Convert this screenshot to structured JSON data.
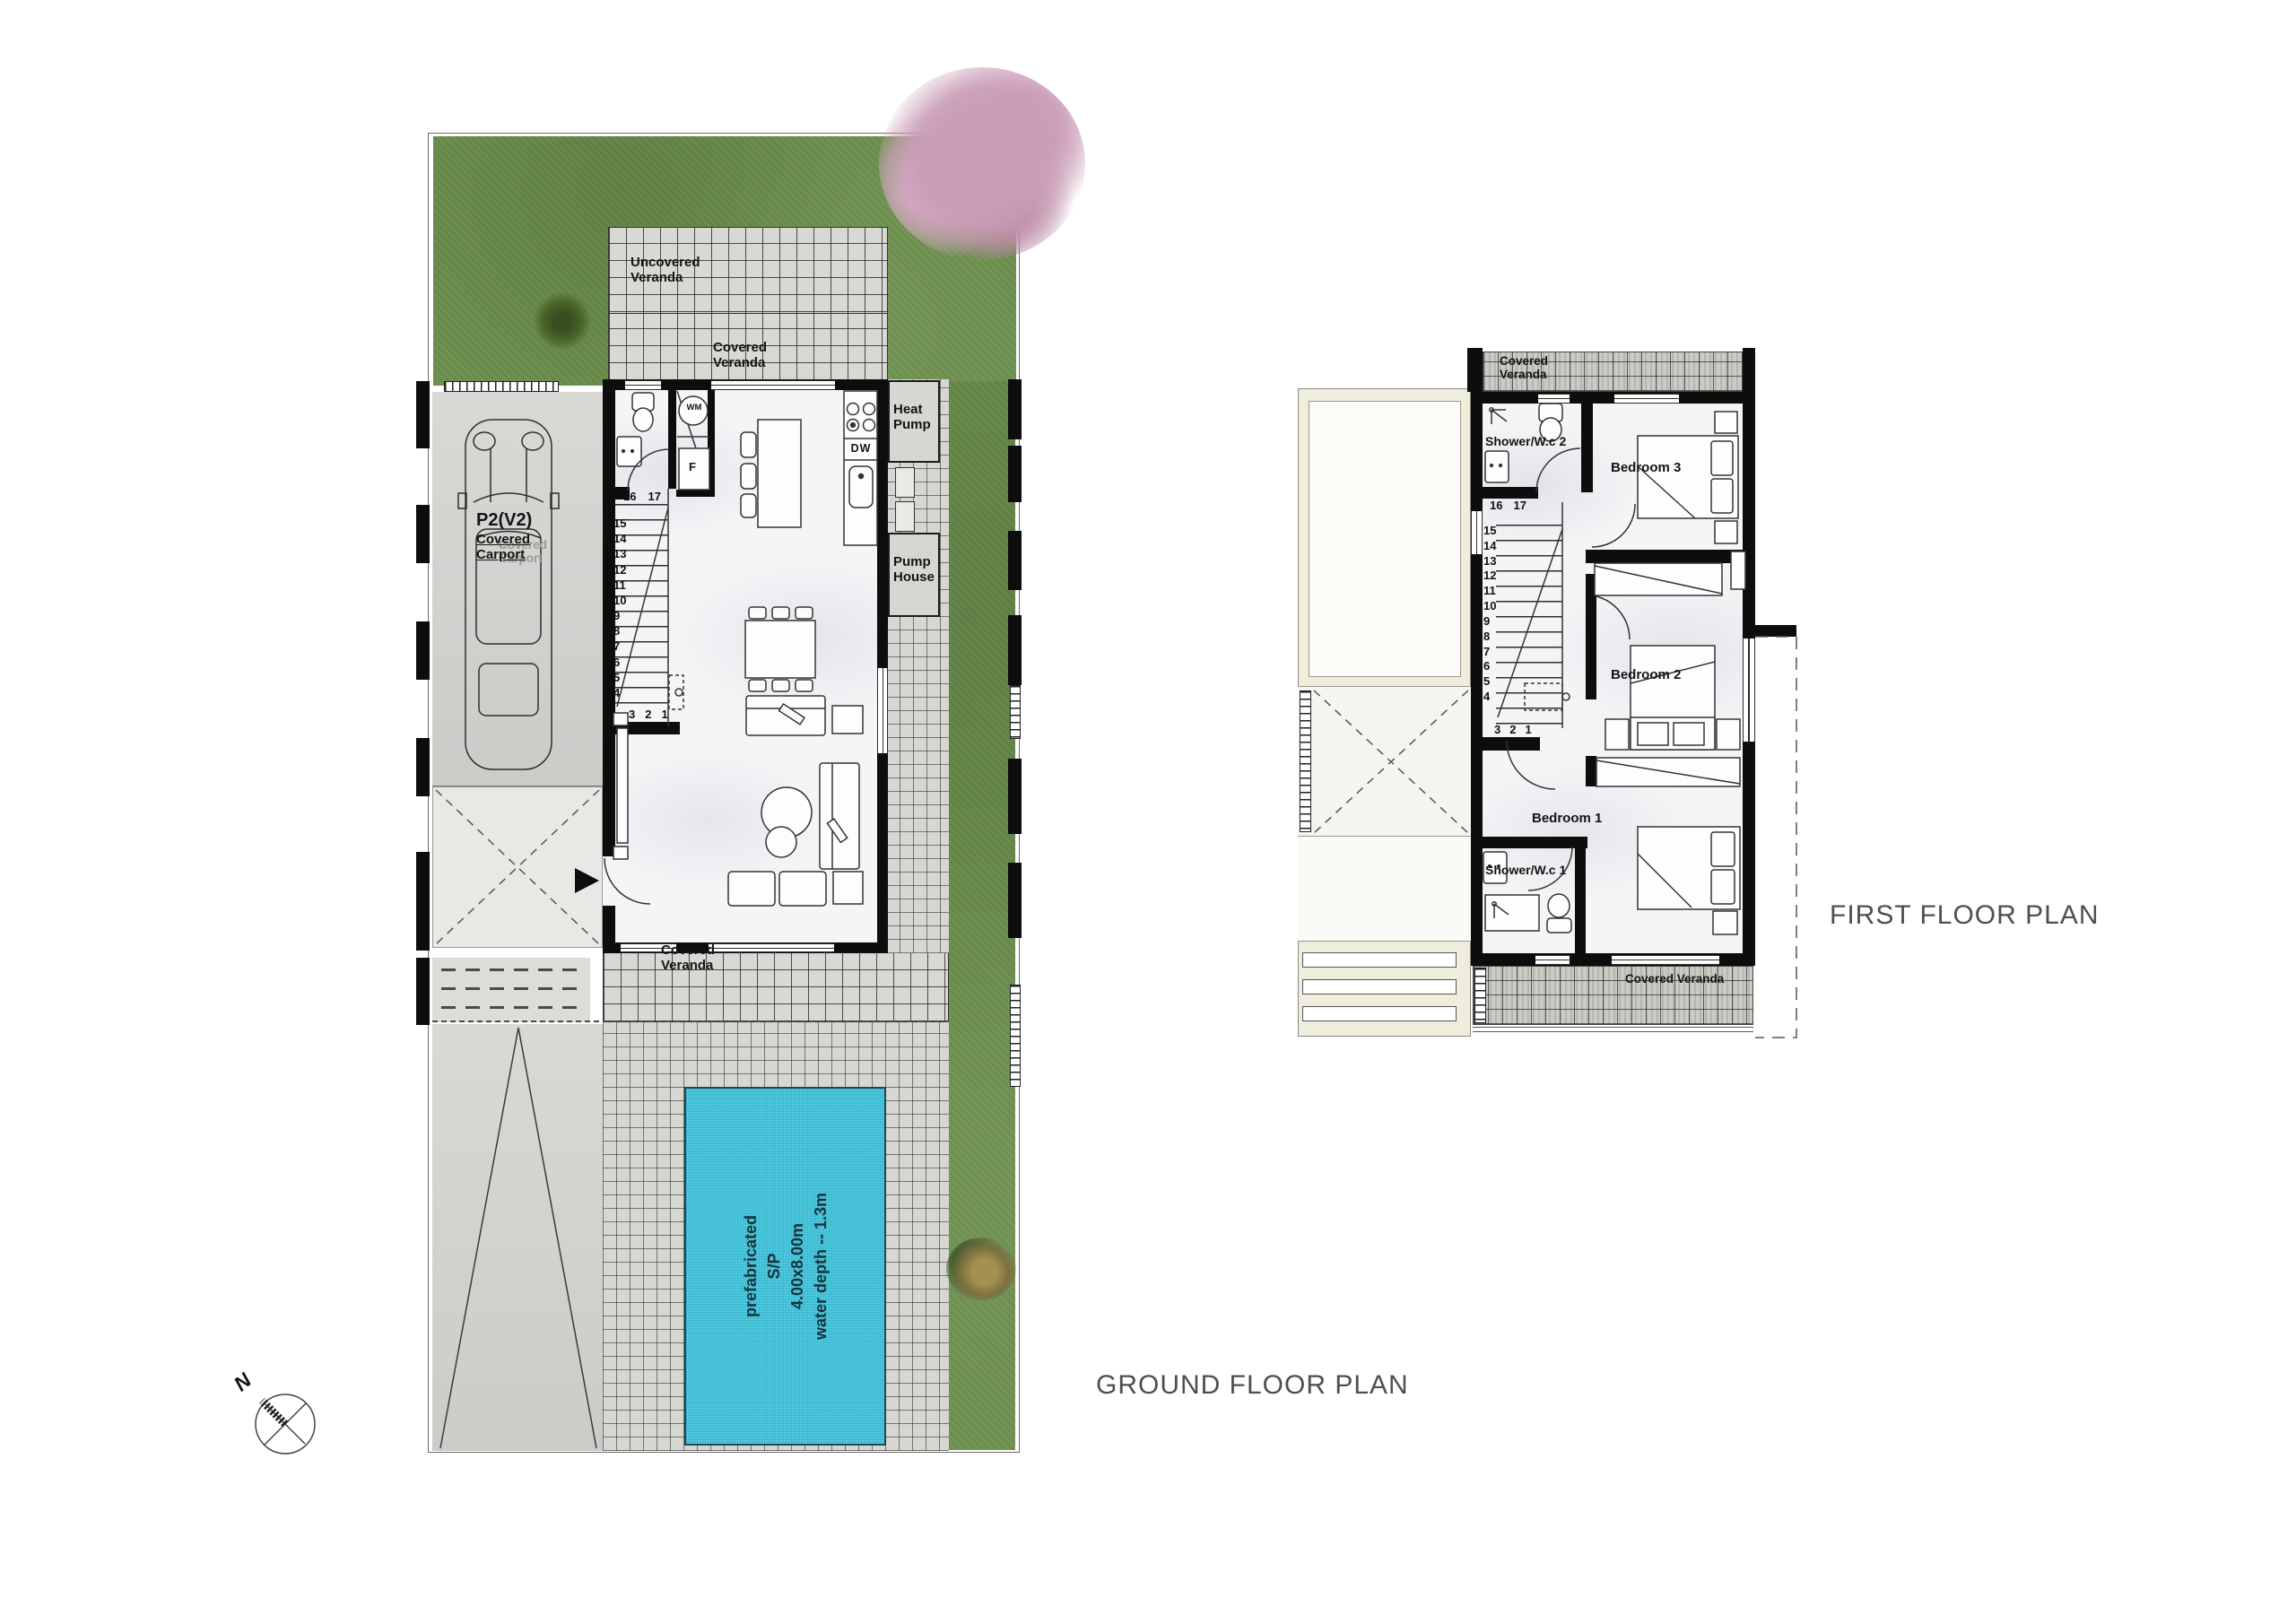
{
  "titles": {
    "ground": "GROUND FLOOR PLAN",
    "first": "FIRST FLOOR PLAN"
  },
  "compass": {
    "north": "N"
  },
  "palette": {
    "grass": "#6c8f4d",
    "pool_water": "#41c3da",
    "wall": "#0d0d0d",
    "tile": "#d8d8d4",
    "roof_cream": "#efeedd",
    "blossom": "#c99db6"
  },
  "ground": {
    "veranda_uncovered": "Uncovered Veranda",
    "veranda_covered_top": "Covered Veranda",
    "veranda_covered_bottom": "Covered Veranda",
    "heat_pump": "Heat Pump",
    "pump_house": "Pump House",
    "carport_code": "P2(V2)",
    "carport_name": "Covered Carport",
    "carport_ghost": "Covered Carport",
    "washing_machine": "WM",
    "fridge": "F",
    "dishwasher": "DW",
    "pool": {
      "l1": "prefabricated",
      "l2": "S/P",
      "l3": "4.00x8.00m",
      "l4": "water depth -- 1.3m"
    },
    "stairs_top": [
      "16",
      "17"
    ],
    "stairs_column": [
      "15",
      "14",
      "13",
      "12",
      "11",
      "10",
      "9",
      "8",
      "7",
      "6",
      "5",
      "4"
    ],
    "stairs_bottom": [
      "3",
      "2",
      "1"
    ]
  },
  "first": {
    "veranda_covered_top": "Covered Veranda",
    "veranda_covered_bottom": "Covered Veranda",
    "shower_wc_2": "Shower/W.c 2",
    "shower_wc_1": "Shower/W.c 1",
    "bedroom_1": "Bedroom 1",
    "bedroom_2": "Bedroom 2",
    "bedroom_3": "Bedroom 3",
    "stairs_top": [
      "16",
      "17"
    ],
    "stairs_column": [
      "15",
      "14",
      "13",
      "12",
      "11",
      "10",
      "9",
      "8",
      "7",
      "6",
      "5",
      "4"
    ],
    "stairs_bottom": [
      "3",
      "2",
      "1"
    ]
  }
}
